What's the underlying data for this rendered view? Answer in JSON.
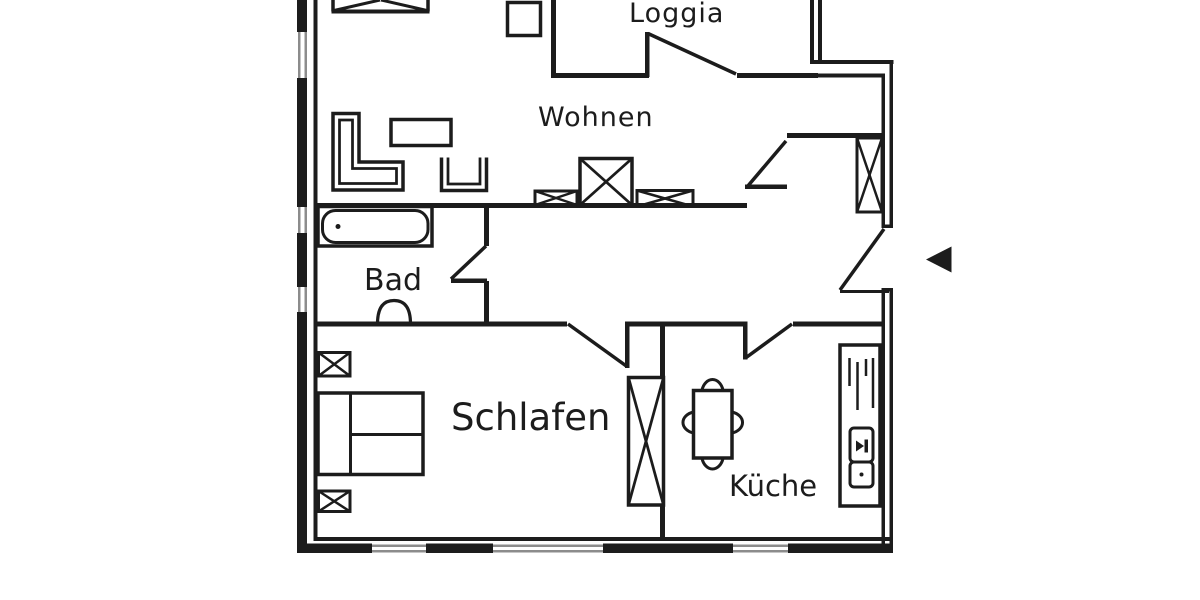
{
  "rooms": {
    "loggia": {
      "label": "Loggia"
    },
    "wohnen": {
      "label": "Wohnen"
    },
    "bad": {
      "label": "Bad"
    },
    "schlafen": {
      "label": "Schlafen"
    },
    "kueche": {
      "label": "Küche"
    }
  },
  "colors": {
    "line": "#1c1c1c",
    "window_line": "#8c8c8c",
    "background": "#ffffff"
  },
  "icons": {
    "entrance_arrow": "left-pointing-entrance-arrow"
  }
}
